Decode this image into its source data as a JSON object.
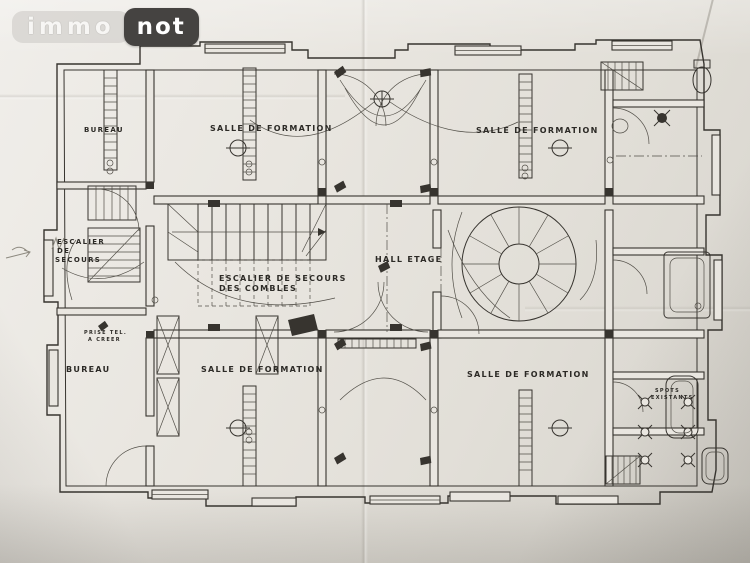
{
  "logo": {
    "immo_label": "immo",
    "not_label": "not"
  },
  "plan": {
    "labels": {
      "bureau_top": "BUREAU",
      "salle_top_center": "SALLE DE FORMATION",
      "salle_top_right": "SALLE DE FORMATION",
      "escalier_secours_l1": "ESCALIER",
      "escalier_secours_l2": "DE",
      "escalier_secours_l3": "SECOURS",
      "escalier_combles_l1": "ESCALIER DE SECOURS",
      "escalier_combles_l2": "DES COMBLES",
      "hall_etage": "HALL ETAGE",
      "prise_tel_l1": "PRISE TEL.",
      "prise_tel_l2": "A CREER",
      "bureau_bottom": "BUREAU",
      "salle_bottom_center": "SALLE DE FORMATION",
      "salle_bottom_right": "SALLE DE FORMATION",
      "spots_l1": "SPOTS",
      "spots_l2": "EXISTANTS"
    },
    "colors": {
      "ink": "#37342f",
      "paper": "#e9e6e0"
    }
  }
}
